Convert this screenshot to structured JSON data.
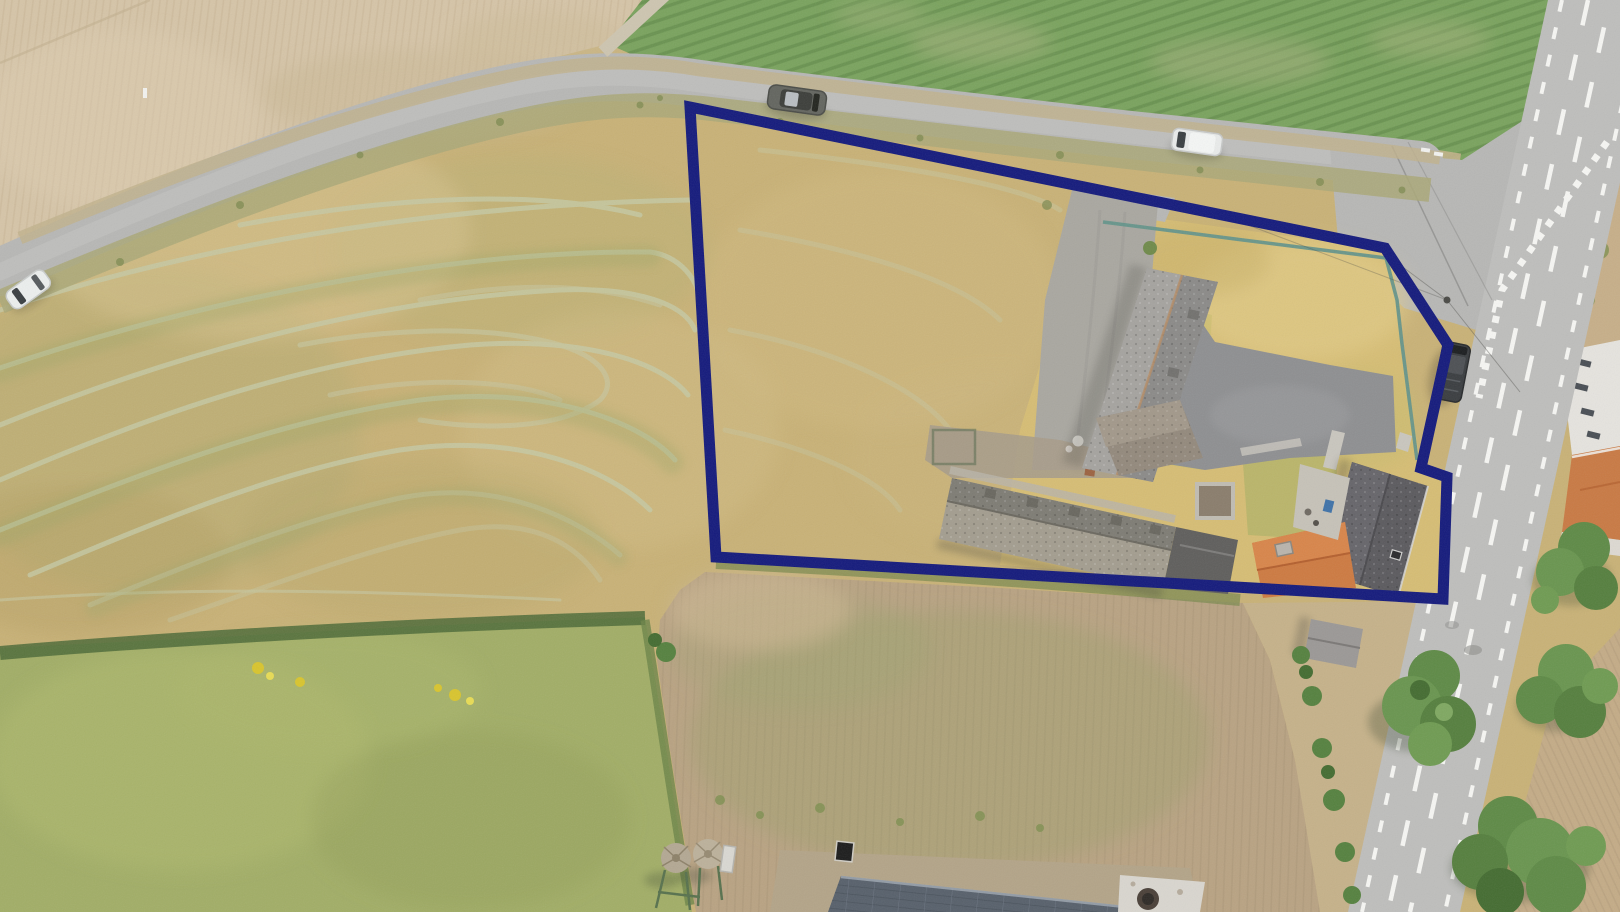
{
  "scene": {
    "type": "aerial-drone-photograph",
    "subject": "Top-down drone photo of a rural farm plot for sale: a mown hay meadow and a farmstead (barns, house, yard) outlined with a thick dark-navy boundary polygon, bordered by a curving country lane on top, a marked main road on the right, a green row-crop field above, pasture and plowed fields below."
  },
  "boundary": {
    "color": "#141a7c",
    "stroke_width": 11,
    "points": "690,107 1385,248 1448,345 1421,468 1447,477 1443,599 716,557"
  },
  "palette": {
    "hay_field": "#c9b277",
    "tilled_field": "#d6c5a8",
    "crop_field": "#7aa35e",
    "pasture": "#a2ae67",
    "plowed_field": "#b9a383",
    "plowed_field_right": "#c4ac87",
    "verge_right": "#c6b28a",
    "lane_asphalt": "#b7b7b5",
    "main_road_asphalt": "#bebebc",
    "road_marking": "#f6f6f3",
    "driveway_gravel": "#a9a7a0",
    "yard_asphalt": "#8e8f91",
    "dry_lawn": "#d6bd74",
    "barn_roof": "#9a9894",
    "old_barn_roof_upper": "#7e7c74",
    "old_barn_roof_lower": "#a39d8f",
    "house_roof": "#5b5a5e",
    "orange_roof": "#cd7a41",
    "solar_barn_roof": "#57606b",
    "concrete_white": "#d9d6cf",
    "tree_green": "#5e8a46",
    "hedge_green": "#4e6b38",
    "fence_teal": "#64938a",
    "windrow_line": "#c6caa6"
  },
  "objects": {
    "vehicles": [
      {
        "name": "gray-suv-driving-lane",
        "color": "#63655f"
      },
      {
        "name": "white-van-parked-lane",
        "color": "#e9ebea"
      },
      {
        "name": "white-car-left-lane",
        "color": "#ecefee"
      },
      {
        "name": "dark-van-parked-at-boundary",
        "color": "#3a3d40"
      }
    ],
    "buildings": [
      {
        "name": "long-barn",
        "roof": "#9a9894"
      },
      {
        "name": "cross-wing",
        "roof": "#93897c"
      },
      {
        "name": "old-stable-barn",
        "roof": "#8d887c"
      },
      {
        "name": "house",
        "roof": "#5b5a5e"
      },
      {
        "name": "orange-roof-wing",
        "roof": "#cd7a41"
      },
      {
        "name": "garden-shed",
        "roof": "#9b9896"
      },
      {
        "name": "solar-roof-barn",
        "roof": "#57606b"
      },
      {
        "name": "neighbour-house-orange-roof",
        "roof": "#c97a44"
      }
    ],
    "silos_count": 2,
    "roads": [
      {
        "name": "country-lane",
        "markings": "none"
      },
      {
        "name": "main-road",
        "markings": "white dashed centre lines, dashed edge lines, yield teeth at merge"
      }
    ]
  }
}
